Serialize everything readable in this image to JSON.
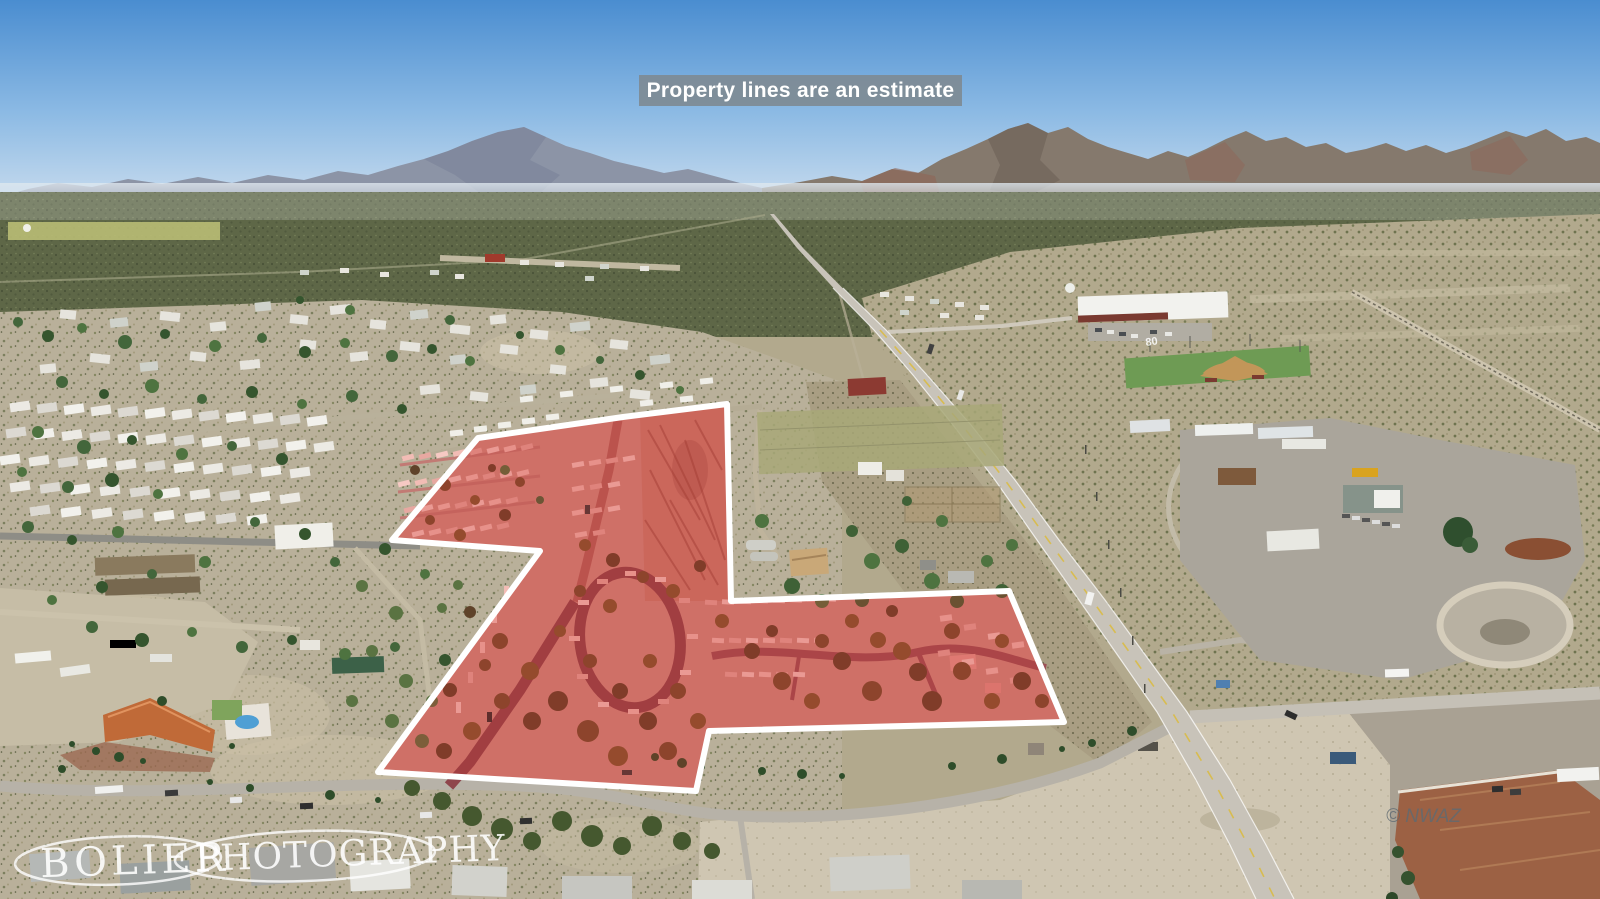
{
  "banner": {
    "text": "Property lines are an estimate"
  },
  "watermark": {
    "word1": "BOLIER",
    "word2": "PHOTOGRAPHY"
  },
  "credit": {
    "text": "© NWAZ"
  },
  "ground_marking": {
    "text": "80"
  },
  "property_outline_points": "623,417 727,404 731,601 1009,591 1064,722 709,731 696,791 378,772 540,551 392,540 478,438",
  "palette": {
    "sky-top": "#4a8dd0",
    "sky-mid": "#8cbae4",
    "sky-horizon": "#c9dcee",
    "banner-bg": "rgba(126,139,148,0.93)",
    "banner-text": "#ffffff",
    "property-tint": "rgba(205,45,40,0.30)",
    "property-border": "#ffffff",
    "scrub-green": "#5e6747",
    "desert-tan": "#b2a98d",
    "road-gray": "#c8c3b9",
    "watermark-white": "rgba(255,255,255,0.88)",
    "credit-gray": "#5f6a72"
  }
}
